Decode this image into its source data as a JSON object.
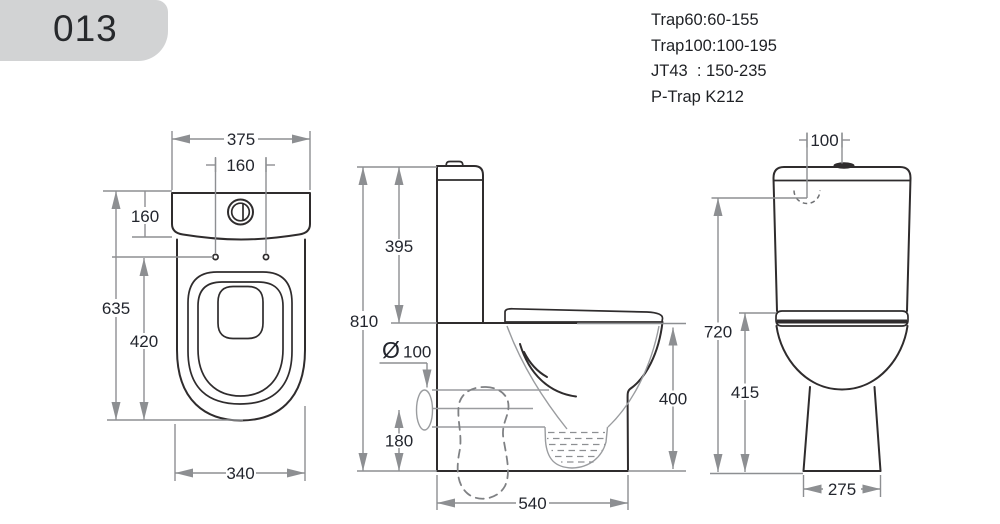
{
  "badge": {
    "label": "013"
  },
  "specs": {
    "line1": "Trap60:60-155",
    "line2": "Trap100:100-195",
    "line3": "JT43  : 150-235",
    "line4": "P-Trap K212"
  },
  "views": {
    "top": {
      "dims": {
        "width": "375",
        "hole_spacing": "160",
        "tank_depth": "160",
        "total_depth": "635",
        "bowl_depth": "420",
        "bowl_width": "340"
      }
    },
    "side": {
      "dims": {
        "tank_height": "395",
        "total_height": "810",
        "outlet_symbol": "Ø",
        "outlet_diameter": "100",
        "outlet_center_height": "180",
        "rim_height": "400",
        "base_depth": "540"
      }
    },
    "front": {
      "dims": {
        "inlet_offset": "100",
        "tank_top_height": "720",
        "seat_height": "415",
        "base_width": "275"
      }
    }
  },
  "colors": {
    "line": "#2f2c2d",
    "dimension": "#8d8f92",
    "dim_text": "#23262e",
    "badge_bg": "#d2d3d4"
  }
}
